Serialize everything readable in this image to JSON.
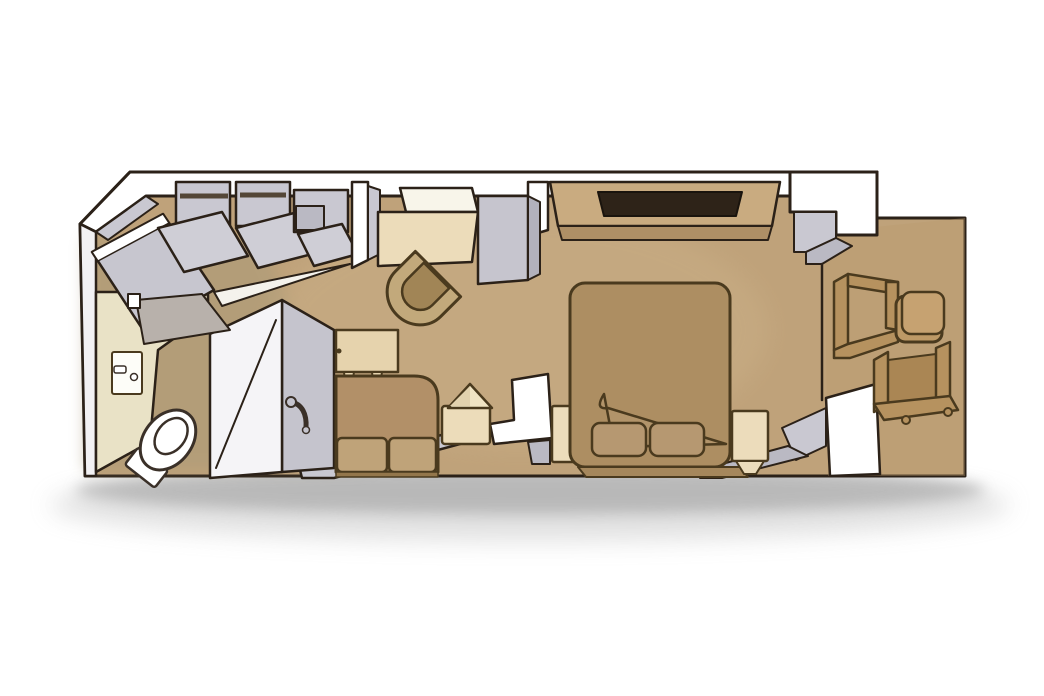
{
  "scene": {
    "title": "Balcony stateroom isometric floor plan",
    "view": "isometric",
    "background": "#ffffff"
  },
  "rooms": [
    "entry",
    "bathroom",
    "wardrobe",
    "desk-area",
    "sitting-area",
    "bedroom",
    "balcony"
  ],
  "items": [
    {
      "name": "entry-door"
    },
    {
      "name": "bathroom-door"
    },
    {
      "name": "door-swing"
    },
    {
      "name": "closet-1"
    },
    {
      "name": "closet-2"
    },
    {
      "name": "storage-cabinet"
    },
    {
      "name": "sink-vanity"
    },
    {
      "name": "toilet"
    },
    {
      "name": "shower"
    },
    {
      "name": "desk-mirror"
    },
    {
      "name": "desk"
    },
    {
      "name": "minibar-cabinet"
    },
    {
      "name": "desk-chair"
    },
    {
      "name": "dresser-tv"
    },
    {
      "name": "console-table"
    },
    {
      "name": "sofa"
    },
    {
      "name": "lamp-table"
    },
    {
      "name": "bed"
    },
    {
      "name": "pillow-left"
    },
    {
      "name": "pillow-right"
    },
    {
      "name": "nightstand-left"
    },
    {
      "name": "nightstand-right"
    },
    {
      "name": "balcony-chair-upper"
    },
    {
      "name": "balcony-chair-lower"
    },
    {
      "name": "balcony-table"
    }
  ],
  "palette": {
    "outline": "#2b2118",
    "furniture_outline": "#4a3a1e",
    "floor": "#bfa27a",
    "floor_light": "#d2b88f",
    "bathroom_floor": "#a89a78",
    "balcony_floor": "#bb9a6e",
    "wall_white": "#ffffff",
    "wall_soft": "#f2f1f3",
    "wall_gray": "#c9c8d1",
    "wall_gray_mid": "#bab9c3",
    "wall_gray_dark": "#b2b1bc",
    "door_gray": "#c7c6cf",
    "bath_door": "#b8b1ab",
    "swing_white": "#f4f2ec",
    "closet_gray": "#c9c8d1",
    "closet_door": "#cfced6",
    "rod_dark": "#544737",
    "counter": "#e9e2c6",
    "sink_white": "#fdfdf8",
    "toilet_white": "#ffffff",
    "shower_white": "#f5f4f7",
    "shower_gray": "#c5c4cd",
    "mirror_white": "#f8f5ea",
    "desk_cream": "#ecdcba",
    "cabinet_gray": "#c6c5ce",
    "chair_rim": "#c2a97b",
    "chair_seat": "#a18556",
    "dresser_top": "#c9ab80",
    "dresser_front": "#ae8f66",
    "tv_dark": "#2e2318",
    "console_cream": "#e6d3ad",
    "sofa_back": "#b29068",
    "sofa_cushion": "#bfa379",
    "sofa_base": "#93764b",
    "lamp_table": "#ecdcba",
    "lamp_shade": "#f0e4c4",
    "lamp_shade_dark": "#e2d2ae",
    "bed": "#ad8e62",
    "pillow": "#b69871",
    "blanket": "#b2946a",
    "bed_base": "#a5875c",
    "nightstand": "#ecdcbb",
    "balcony_wood": "#b6925f",
    "balcony_wood_light": "#c6a271",
    "balcony_table": "#bd9966",
    "balcony_inner": "#aa8654",
    "shadow": "#a8a8a8"
  }
}
